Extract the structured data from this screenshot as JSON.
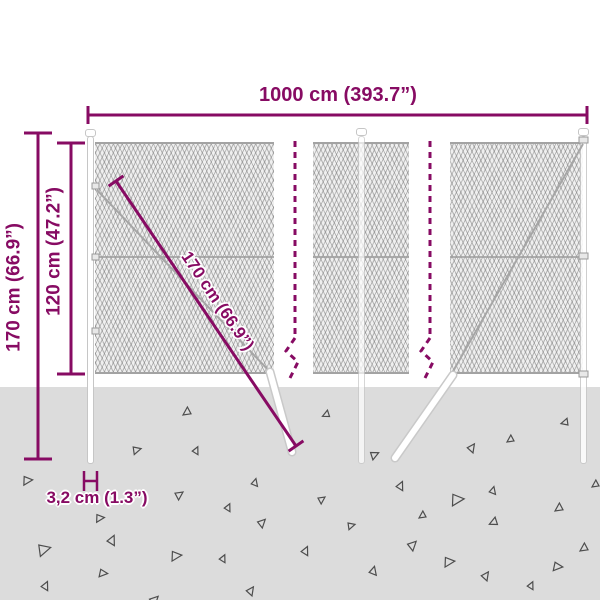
{
  "labels": {
    "total_width": "1000 cm (393.7”)",
    "post_height": "170 cm (66.9”)",
    "mesh_height": "120 cm (47.2”)",
    "brace_length": "170 cm (66.9”)",
    "post_thickness": "3,2 cm (1.3”)"
  },
  "colors": {
    "dimension": "#870b63",
    "ground": "#dcdcdc",
    "debris": "#4d4d4d",
    "wire": "#a6a6a6",
    "post_outline": "#c6c6c6"
  },
  "decor": {
    "triangles": [
      [
        183,
        407,
        8,
        0
      ],
      [
        323,
        410,
        7,
        10
      ],
      [
        370,
        452,
        8,
        190
      ],
      [
        468,
        445,
        8,
        160
      ],
      [
        507,
        435,
        7,
        0
      ],
      [
        562,
        418,
        7,
        20
      ],
      [
        132,
        447,
        8,
        200
      ],
      [
        193,
        448,
        7,
        150
      ],
      [
        22,
        477,
        9,
        210
      ],
      [
        175,
        492,
        8,
        180
      ],
      [
        252,
        480,
        7,
        140
      ],
      [
        258,
        520,
        8,
        170
      ],
      [
        37,
        545,
        12,
        200
      ],
      [
        108,
        537,
        9,
        150
      ],
      [
        98,
        570,
        8,
        220
      ],
      [
        42,
        583,
        8,
        150
      ],
      [
        247,
        588,
        8,
        160
      ],
      [
        150,
        597,
        9,
        170
      ],
      [
        318,
        497,
        7,
        180
      ],
      [
        397,
        483,
        8,
        150
      ],
      [
        450,
        495,
        12,
        210
      ],
      [
        490,
        488,
        7,
        140
      ],
      [
        555,
        503,
        8,
        0
      ],
      [
        347,
        523,
        7,
        200
      ],
      [
        302,
        548,
        8,
        150
      ],
      [
        408,
        542,
        9,
        170
      ],
      [
        443,
        558,
        10,
        210
      ],
      [
        370,
        568,
        8,
        140
      ],
      [
        482,
        573,
        8,
        160
      ],
      [
        528,
        583,
        7,
        150
      ],
      [
        580,
        543,
        8,
        0
      ],
      [
        552,
        563,
        9,
        220
      ],
      [
        490,
        517,
        8,
        10
      ],
      [
        225,
        505,
        7,
        150
      ],
      [
        95,
        515,
        8,
        210
      ],
      [
        419,
        511,
        7,
        0
      ],
      [
        170,
        552,
        10,
        210
      ],
      [
        220,
        556,
        7,
        150
      ],
      [
        592,
        480,
        7,
        0
      ]
    ]
  }
}
